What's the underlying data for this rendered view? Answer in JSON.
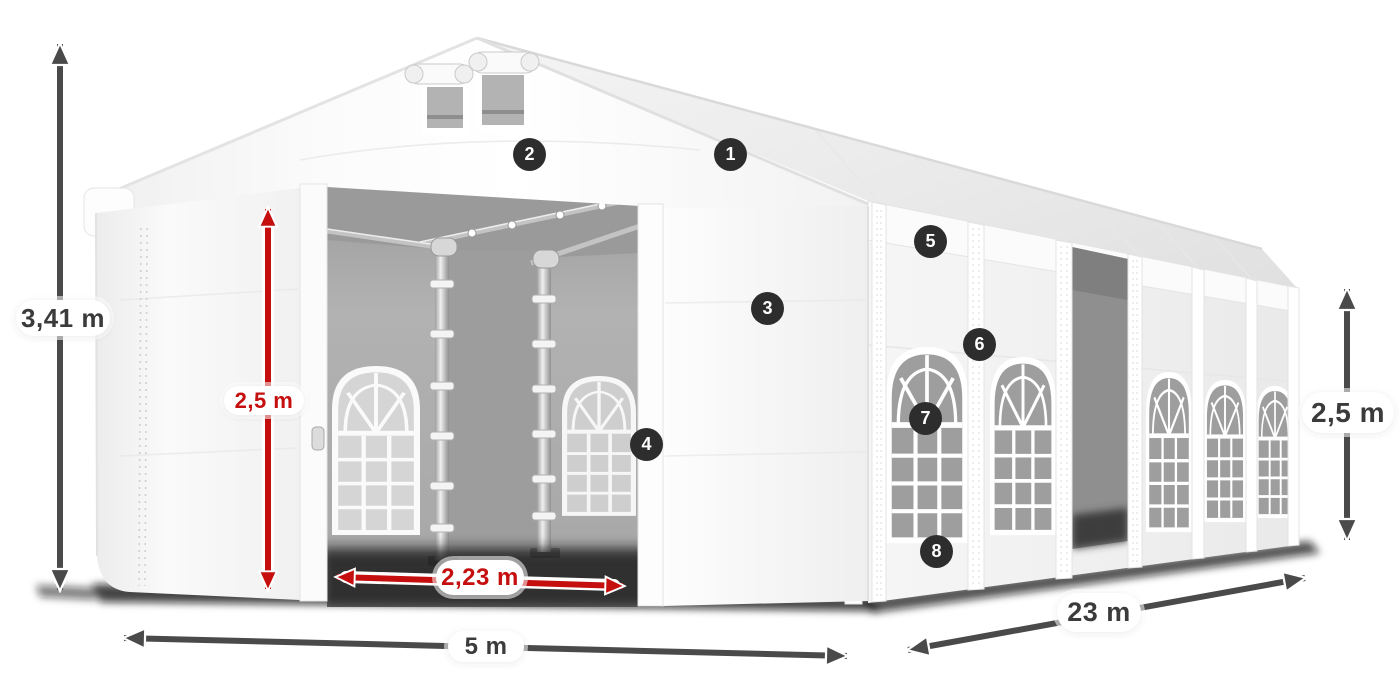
{
  "diagram": {
    "type": "product-dimension-diagram",
    "subject": "white marquee tent with gable roof, open front entrance doors, side windows and side sliding door"
  },
  "dimensions": {
    "total_height": "3,41 m",
    "entrance_height": "2,5 m",
    "entrance_width": "2,23 m",
    "front_width": "5 m",
    "length": "23 m",
    "side_height": "2,5 m"
  },
  "callouts": [
    {
      "number": "1"
    },
    {
      "number": "2"
    },
    {
      "number": "3"
    },
    {
      "number": "4"
    },
    {
      "number": "5"
    },
    {
      "number": "6"
    },
    {
      "number": "7"
    },
    {
      "number": "8"
    }
  ],
  "colors": {
    "accent_red": "#c50f0f",
    "arrow_gray": "#4a4a4a",
    "badge_bg": "#2d2d2d",
    "badge_text": "#ffffff",
    "label_bg": "#ffffff",
    "label_text": "#3b3b3b",
    "page_bg": "#ffffff"
  }
}
